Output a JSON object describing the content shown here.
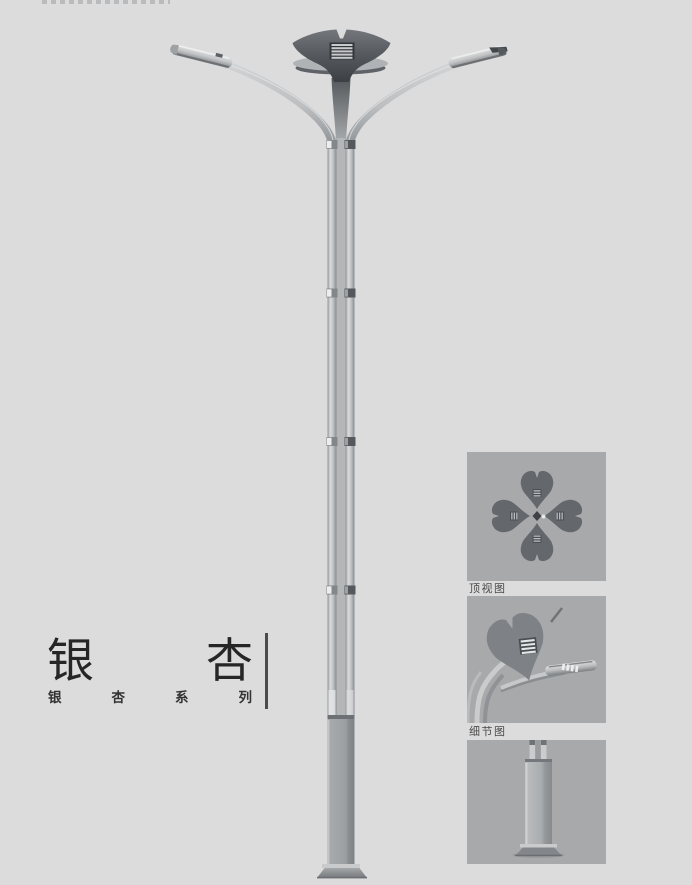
{
  "title_block": {
    "title_chars": [
      "银",
      "杏"
    ],
    "subtitle_chars": [
      "银",
      "杏",
      "系",
      "列"
    ]
  },
  "panels": {
    "top_view": {
      "caption": "顶视图"
    },
    "detail_view": {
      "caption": "细节图"
    }
  },
  "colors": {
    "page_background": "#dcdcdd",
    "panel_background": "#a7a9ab",
    "metal_light": "#d6d8da",
    "metal_mid": "#c2c4c6",
    "metal_dark": "#8f9294",
    "crown_dark": "#3c4044",
    "base_column": "#9b9ea1",
    "title_text": "#262626",
    "caption_text": "#4a4a4a"
  }
}
